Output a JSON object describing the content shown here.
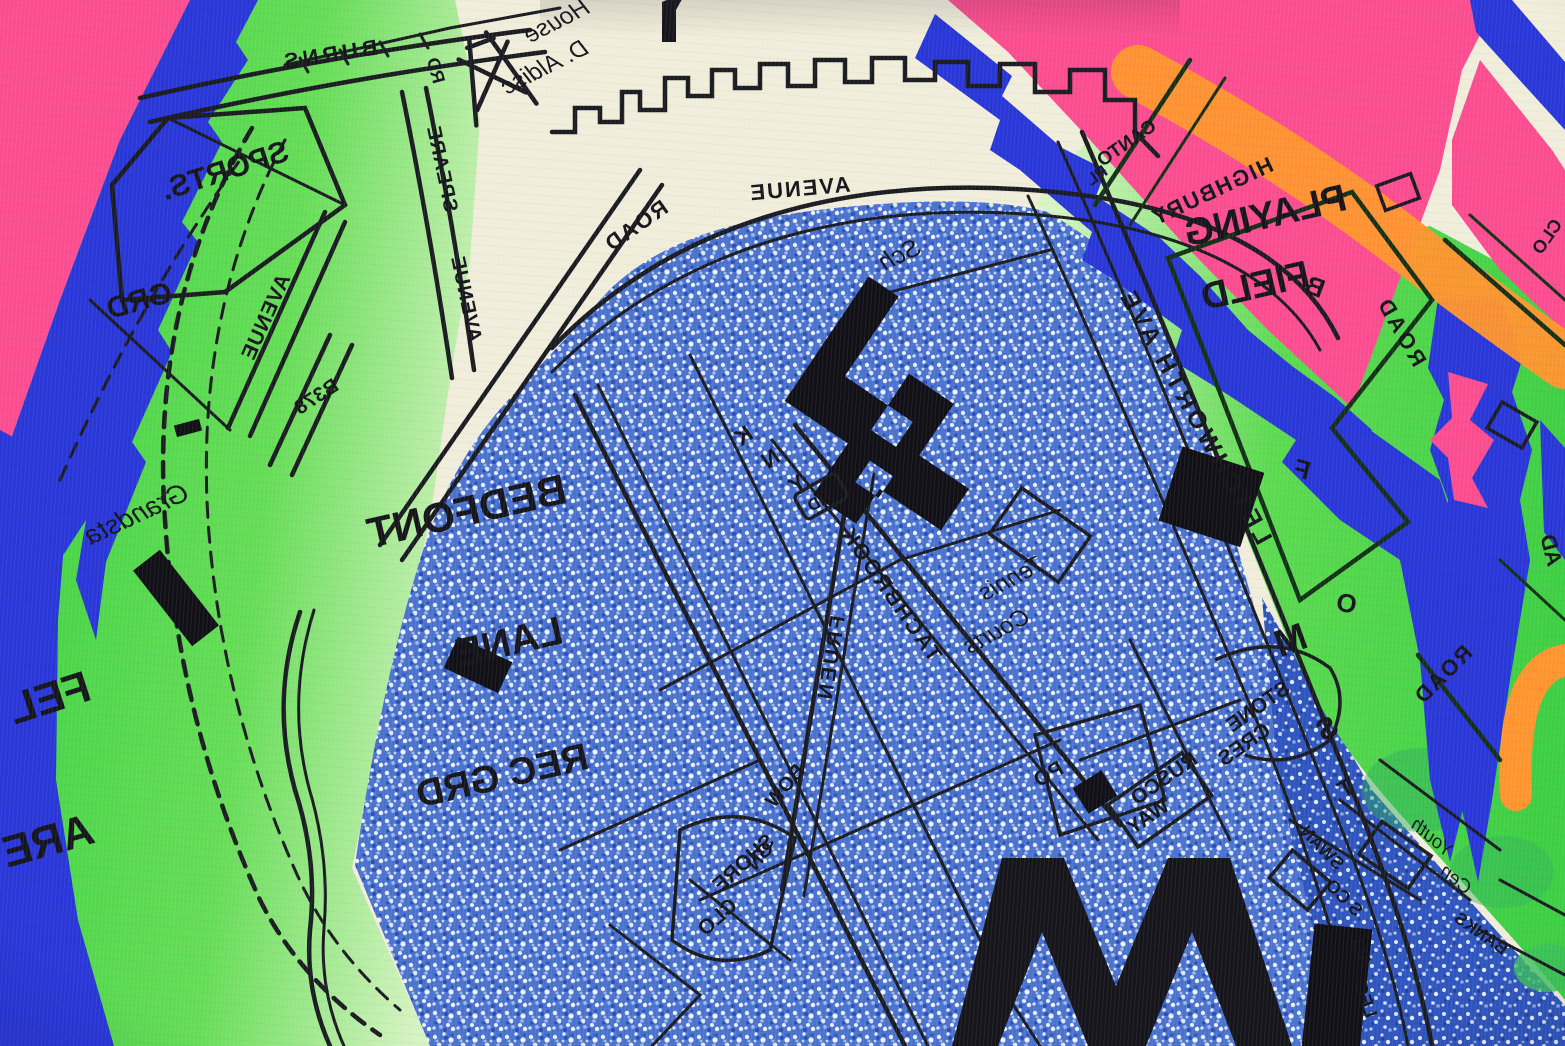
{
  "scene": {
    "subject": "close-up of neon map-print fabric, map text appears mirrored",
    "map_area": "Feltham / Bedfont street map print"
  },
  "colors": {
    "cream": "#f1eddb",
    "neon_green": "#46d444",
    "pale_green": "#cff0bb",
    "royal_blue": "#2937d8",
    "speckle_blue": "#4a72cf",
    "speckle_blue_dark": "#2f55be",
    "neon_pink": "#fb4d90",
    "orange": "#ff952f",
    "ink": "#15151b"
  },
  "labels": {
    "burns": "BURNS",
    "sports": "SPORTS.",
    "sports_grd": "GRD",
    "rd_small": "RD",
    "speare": "SPEARE",
    "avenue_west": "AVENUE",
    "avenue_shake": "AVENUE",
    "avenue_arc": "AVENUE",
    "highbury": "HIGHBURY",
    "road_left": "ROAD",
    "bedfont": "BEDFONT",
    "lane": "LANE",
    "rec_grd": "REC GRD",
    "grandstand": "Grandsta",
    "fel": "FEL",
    "are": "ARE",
    "house": "House",
    "d_aldisc": "D. Aldisc",
    "b378": "B378",
    "playing": "PLAYING",
    "field": "FIELD",
    "canton": "CANTO",
    "pl": "PL",
    "letchworth": "LETCHWORTH AVE",
    "sch": "Sch",
    "tennis": "Tennis",
    "courts": "Courts",
    "tachbrook": "TACHBROOK",
    "rd_box": "RD",
    "fruen": "FRUEN",
    "bow": "BOW",
    "gn": "GN",
    "k": "K",
    "n": "N",
    "y": "Y",
    "b": "B",
    "f": "F",
    "o": "O",
    "m": "M",
    "s": "S",
    "t": "T",
    "stone": "STONE",
    "cres": "CRES",
    "rusco": "RUSCO",
    "way": "WAY",
    "shore": "SHORE",
    "clo": "CLO",
    "po": "PO",
    "road_green": "ROAD",
    "road_edge": "ROAD",
    "ad": "AD",
    "clo_edge": "CLO",
    "swan": "SWAN",
    "s_co": "S CO",
    "all": "ALL",
    "lec": "LEC",
    "youth": "Youth",
    "cen": "Cen",
    "banks": "BANKS"
  }
}
